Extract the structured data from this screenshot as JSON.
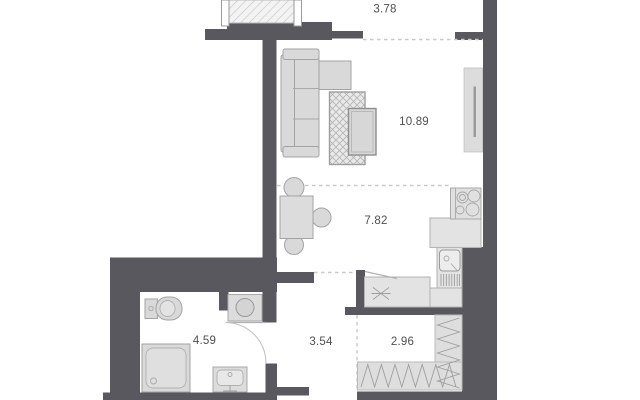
{
  "plan": {
    "type": "apartment-floor-plan",
    "rooms": [
      {
        "id": "balcony",
        "area": "3.78"
      },
      {
        "id": "living-room",
        "area": "10.89"
      },
      {
        "id": "kitchen-dining",
        "area": "7.82"
      },
      {
        "id": "hallway",
        "area": "3.54"
      },
      {
        "id": "storage",
        "area": "2.96"
      },
      {
        "id": "bathroom",
        "area": "4.59"
      }
    ],
    "colors": {
      "wall": "#58585e",
      "furniture_fill": "#d9d9d9",
      "furniture_stroke": "#a3a3a3",
      "counter_fill": "#e3e3e3",
      "hatch_line": "#9e9e9e",
      "label": "#4f4f4f",
      "dash": "#c9c9c9",
      "background": "#ffffff"
    }
  }
}
